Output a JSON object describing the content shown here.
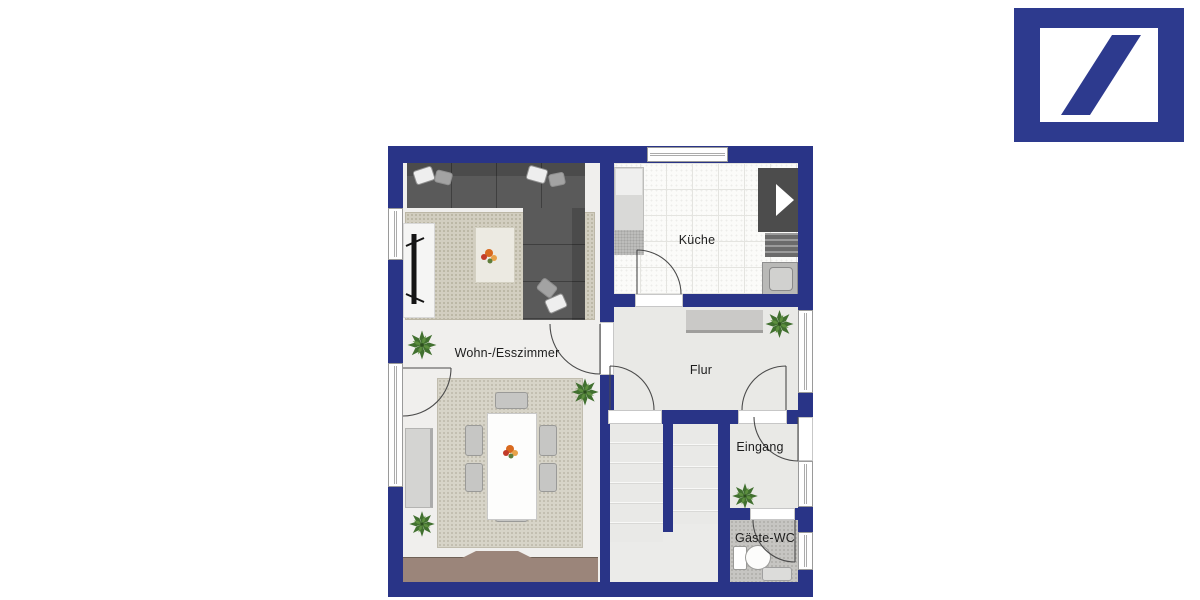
{
  "page": {
    "background": "#ffffff"
  },
  "logo": {
    "name": "Deutsche Bank",
    "color": "#2d3a8e"
  },
  "floor_plan": {
    "wall_color": "#293487",
    "floor_color": "#efefec",
    "rug_color": "#d2cec0",
    "deck_color": "#9b857a",
    "rooms": [
      {
        "id": "kueche",
        "label": "Küche"
      },
      {
        "id": "wohn-esszimmer",
        "label": "Wohn-/Esszimmer"
      },
      {
        "id": "flur",
        "label": "Flur"
      },
      {
        "id": "eingang",
        "label": "Eingang"
      },
      {
        "id": "gaeste-wc",
        "label": "Gäste-WC"
      }
    ]
  }
}
